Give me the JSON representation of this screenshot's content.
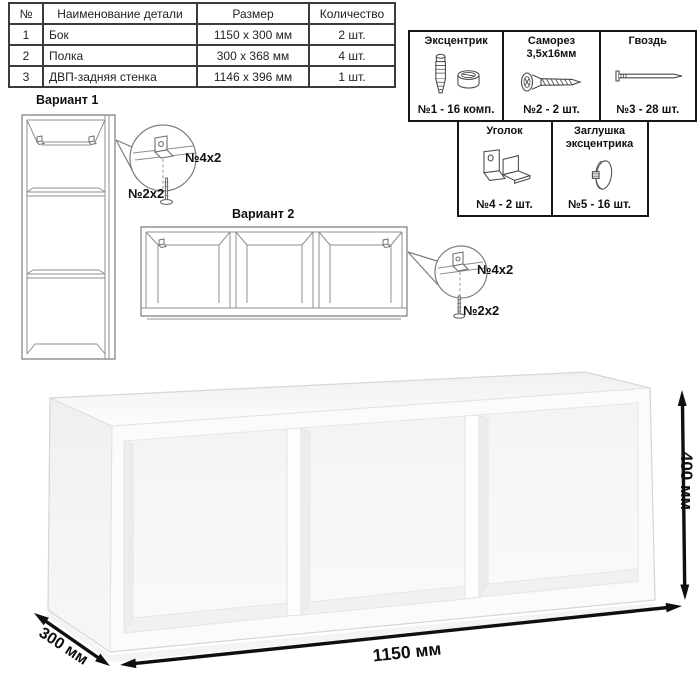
{
  "parts_table": {
    "headers": {
      "num": "№",
      "name": "Наименование детали",
      "size": "Размер",
      "qty": "Количество"
    },
    "rows": [
      {
        "num": "1",
        "name": "Бок",
        "size": "1150 x 300 мм",
        "qty": "2 шт."
      },
      {
        "num": "2",
        "name": "Полка",
        "size": "300 x 368 мм",
        "qty": "4 шт."
      },
      {
        "num": "3",
        "name": "ДВП-задняя стенка",
        "size": "1146 x 396 мм",
        "qty": "1 шт."
      }
    ]
  },
  "hardware": {
    "items": [
      {
        "title": "Эксцентрик",
        "qty": "№1 - 16 комп.",
        "icon": "cam-and-dowel-icon"
      },
      {
        "title": "Саморез 3,5х16мм",
        "qty": "№2 - 2 шт.",
        "icon": "screw-icon"
      },
      {
        "title": "Гвоздь",
        "qty": "№3 - 28 шт.",
        "icon": "nail-icon"
      },
      {
        "title": "Уголок",
        "qty": "№4 - 2 шт.",
        "icon": "corner-bracket-icon"
      },
      {
        "title": "Заглушка эксцентрика",
        "qty": "№5 - 16 шт.",
        "icon": "cam-cap-icon"
      }
    ]
  },
  "variants": {
    "v1": {
      "title": "Вариант 1",
      "bracket_label": "№4х2",
      "screw_label": "№2х2"
    },
    "v2": {
      "title": "Вариант 2",
      "bracket_label": "№4х2",
      "screw_label": "№2х2"
    }
  },
  "dimensions": {
    "width": "1150 мм",
    "height": "400 мм",
    "depth": "300 мм"
  },
  "colors": {
    "ink": "#1a1a1a",
    "drawing_line": "#8f8f8f",
    "dimension": "#0d0d0d"
  }
}
